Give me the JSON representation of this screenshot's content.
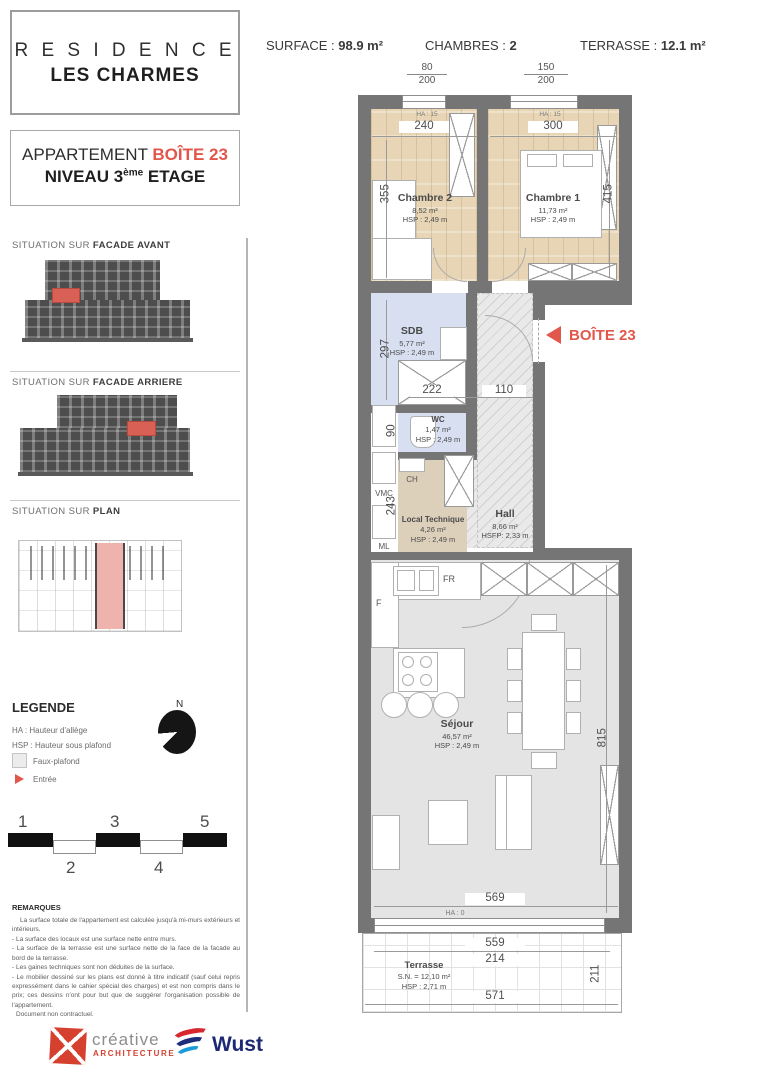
{
  "title": {
    "line1": "R E S I D E N C E",
    "line2": "LES CHARMES"
  },
  "stats": {
    "surface_label": "SURFACE :",
    "surface_value": "98.9 m²",
    "rooms_label": "CHAMBRES :",
    "rooms_value": "2",
    "terrace_label": "TERRASSE :",
    "terrace_value": "12.1 m²"
  },
  "apartment": {
    "prefix": "APPARTEMENT",
    "unit": "BOÎTE 23",
    "level_prefix": "NIVEAU 3",
    "level_sup": "ème",
    "level_suffix": "ETAGE"
  },
  "sections": {
    "facade_front": {
      "prefix": "SITUATION SUR",
      "name": "FACADE AVANT"
    },
    "facade_rear": {
      "prefix": "SITUATION SUR",
      "name": "FACADE ARRIERE"
    },
    "plan": {
      "prefix": "SITUATION SUR",
      "name": "PLAN"
    }
  },
  "legend": {
    "title": "LEGENDE",
    "items": [
      {
        "label": "HA : Hauteur d'allège"
      },
      {
        "label": "HSP : Hauteur sous plafond"
      },
      {
        "label": "Faux-plafond"
      },
      {
        "label": "Entrée"
      }
    ],
    "north": "N"
  },
  "scalebar": {
    "n1": "1",
    "n2": "2",
    "n3": "3",
    "n4": "4",
    "n5": "5"
  },
  "remarks": {
    "title": "REMARQUES",
    "lines": [
      "La surface totale de l'appartement est calculée jusqu'à mi-murs extérieurs et intérieurs.",
      "- La surface des locaux est une surface nette entre murs.",
      "- La surface de la terrasse est une surface nette de la face de la facade au bord de la terrasse.",
      "- Les gaines techniques sont non déduites de la surface.",
      "- Le mobilier dessiné sur les plans est donné à titre indicatif (sauf celui repris expressément dans le cahier spécial des charges) et est non compris dans le prix; ces dessins n'ont pour but que de suggérer l'organisation possible de l'appartement.",
      "Document non contractuel."
    ]
  },
  "footer": {
    "creative_name": "créative",
    "creative_sub": "ARCHITECTURE",
    "wust": "Wust"
  },
  "floorplan": {
    "windows": [
      {
        "over": "80",
        "under": "200",
        "ha": "HA : 15"
      },
      {
        "over": "150",
        "under": "200",
        "ha": "HA : 15"
      }
    ],
    "rooms": [
      {
        "name": "Chambre 2",
        "area": "8,52 m²",
        "h": "HSP : 2,49 m"
      },
      {
        "name": "Chambre 1",
        "area": "11,73 m²",
        "h": "HSP : 2,49 m"
      },
      {
        "name": "SDB",
        "area": "5,77 m²",
        "h": "HSP : 2,49 m"
      },
      {
        "name": "WC",
        "area": "1,47 m²",
        "h": "HSP : 2,49 m"
      },
      {
        "name": "Local Technique",
        "area": "4,26 m²",
        "h": "HSP : 2,49 m"
      },
      {
        "name": "Hall",
        "area": "8,66 m²",
        "h": "HSFP: 2,33 m"
      },
      {
        "name": "Séjour",
        "area": "46,57 m²",
        "h": "HSP : 2,49 m"
      },
      {
        "name": "Terrasse",
        "area": "S.N. = 12,10 m²",
        "h": "HSP : 2,71 m"
      }
    ],
    "dims": {
      "c2w": "240",
      "c1w": "300",
      "c2h": "355",
      "c1h": "415",
      "sdbh": "297",
      "bath": "222",
      "hall": "110",
      "wc": "90",
      "lt": "243",
      "sejh": "815",
      "sejw": "569",
      "ha0": "HA : 0",
      "terr1": "559",
      "terr2": "214",
      "terr3": "571",
      "terrh": "211"
    },
    "appliances": {
      "ch": "CH",
      "vmc": "VMC",
      "ml": "ML",
      "fr": "FR",
      "f": "F"
    },
    "entry": {
      "label": "BOÎTE 23"
    }
  },
  "colors": {
    "accent_red": "#e2574c",
    "highlight_pink": "#efb3ae",
    "wall_grey": "#757575"
  }
}
